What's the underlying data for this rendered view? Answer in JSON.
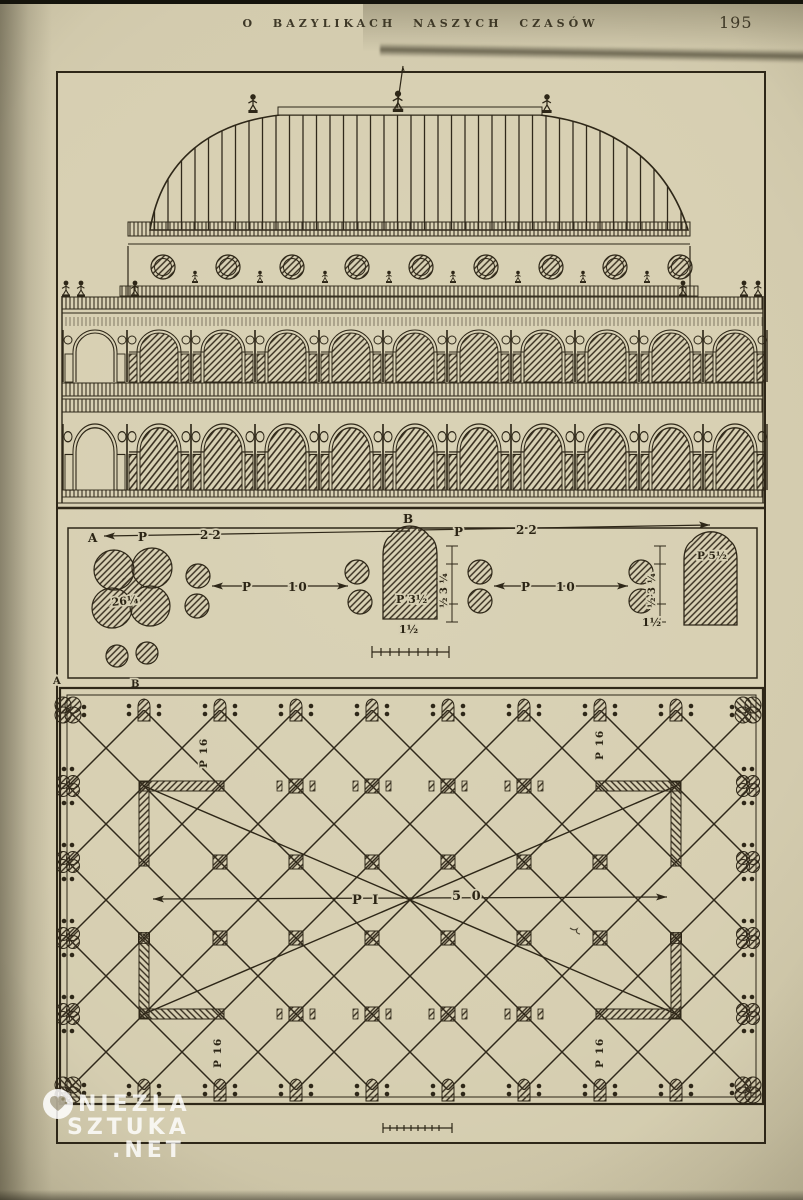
{
  "page": {
    "running_header": "O BAZYLIKACH NASZYCH CZASÓW",
    "page_number": "195"
  },
  "plate": {
    "section_labels": {
      "a_top": "A",
      "b_top": "B",
      "a_bottom": "A",
      "b_bottom": "B"
    },
    "detail_strip": {
      "span_left": {
        "prefix": "P",
        "value": "22"
      },
      "span_right": {
        "prefix": "P",
        "value": "22"
      },
      "col_gap_left": {
        "prefix": "P",
        "value": "10"
      },
      "col_gap_right": {
        "prefix": "P",
        "value": "10"
      },
      "pier_left_dim": "26¼",
      "pier_center_dim": "P 3½",
      "pier_right_dim": "P 5½",
      "below_center_dim": "1½",
      "below_right_dim": "1½",
      "tick_dims_left": "½ 3 ¼",
      "tick_dims_right": "½ 3 ¼"
    },
    "plan": {
      "hall_span": {
        "prefix": "P I",
        "value": "5 0"
      },
      "bay_dim": "P 16"
    }
  },
  "watermark": {
    "line1": "NIEZLA",
    "line2": "SZTUKA",
    "line3": ".NET"
  },
  "colors": {
    "paper": "#d3cbae",
    "plate_paper": "#dad3b7",
    "ink": "#2e2718",
    "watermark": "#ffffff"
  }
}
